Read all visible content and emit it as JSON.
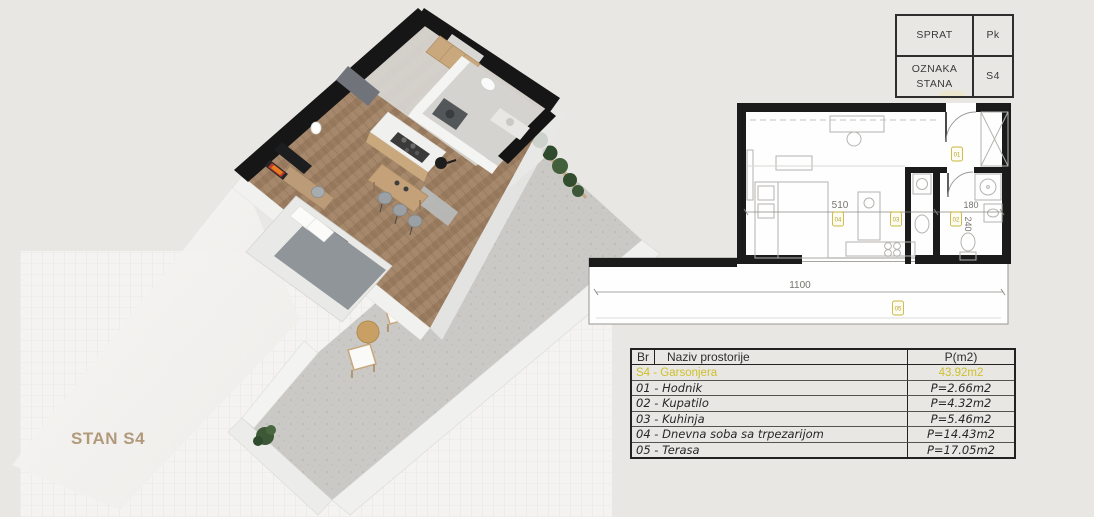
{
  "unit_label": "STAN S4",
  "colors": {
    "background": "#e9e7e4",
    "panel": "#f4f3f1",
    "wall_black": "#1b1b1b",
    "accent_yellow": "#cdc02c",
    "label_tan": "#b19a7b"
  },
  "info_box": {
    "rows": [
      {
        "label": "SPRAT",
        "value": "Pk"
      },
      {
        "label": "OZNAKA STANA",
        "value": "S4"
      }
    ]
  },
  "plan": {
    "dimensions": {
      "living_width": "510",
      "bathroom_width": "180",
      "bathroom_depth": "240",
      "terrace_width": "1100"
    },
    "markers": [
      {
        "id": "01",
        "room": "Hodnik"
      },
      {
        "id": "02",
        "room": "Kupatilo"
      },
      {
        "id": "03",
        "room": "Kuhinja"
      },
      {
        "id": "04",
        "room": "Dnevna soba sa trpezarijom"
      },
      {
        "id": "05",
        "room": "Terasa"
      }
    ]
  },
  "area_table": {
    "headers": {
      "br": "Br",
      "name": "Naziv prostorije",
      "area": "P(m2)"
    },
    "summary": {
      "name": "S4 - Garsonjera",
      "area": "43.92m2"
    },
    "rows": [
      {
        "name": "01 - Hodnik",
        "area": "P=2.66m2"
      },
      {
        "name": "02 - Kupatilo",
        "area": "P=4.32m2"
      },
      {
        "name": "03 - Kuhinja",
        "area": "P=5.46m2"
      },
      {
        "name": "04 - Dnevna soba sa trpezarijom",
        "area": "P=14.43m2"
      },
      {
        "name": "05 - Terasa",
        "area": "P=17.05m2"
      }
    ]
  }
}
